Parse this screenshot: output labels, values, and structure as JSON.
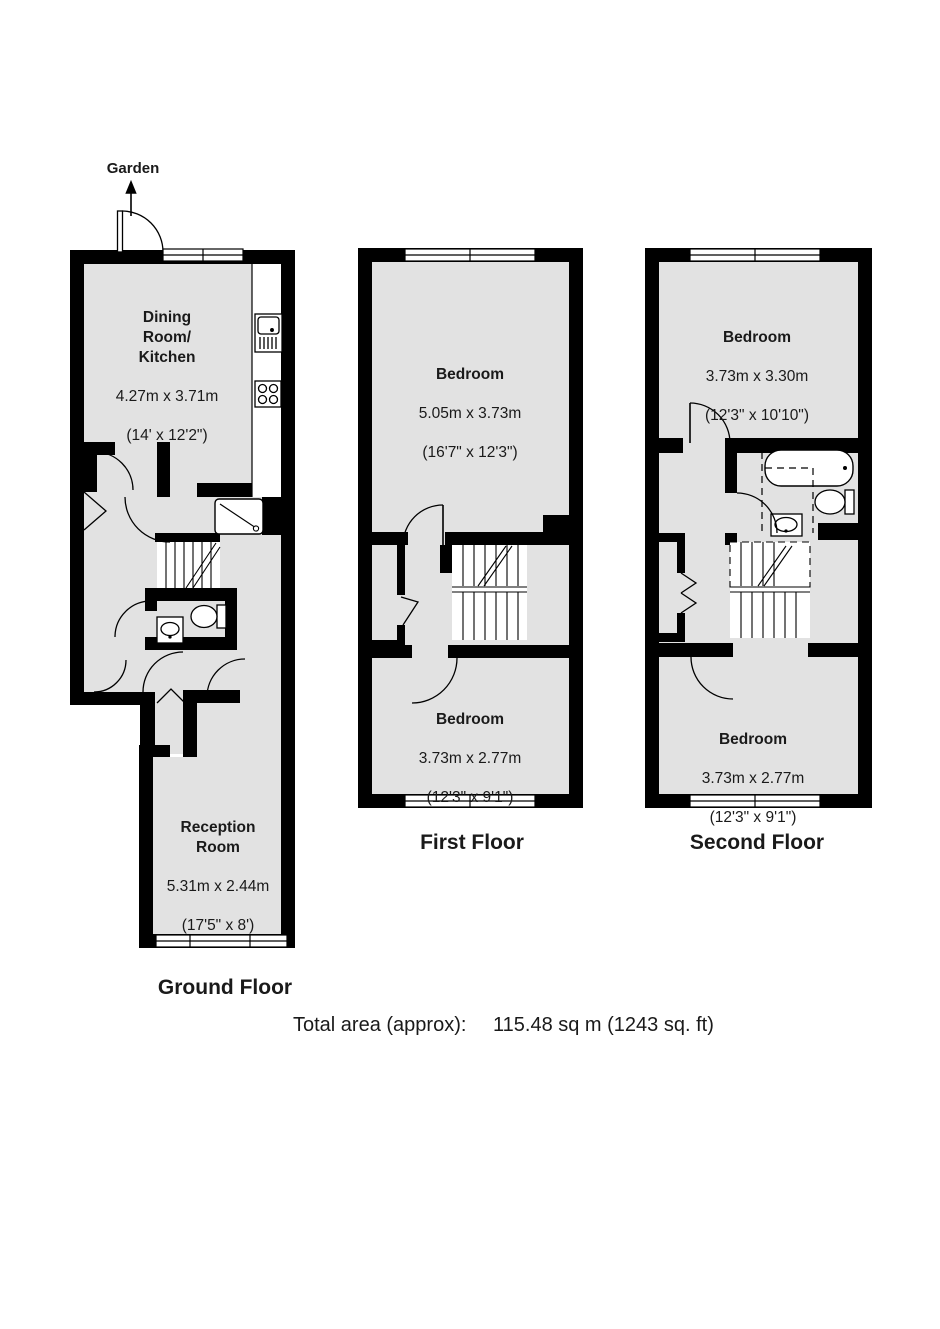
{
  "page": {
    "background": "#ffffff",
    "wall_color": "#000000",
    "room_fill": "#e2e2e2",
    "line_color": "#000000",
    "text_color": "#1a1a1a"
  },
  "garden": {
    "label": "Garden"
  },
  "floors": {
    "ground": {
      "caption": "Ground Floor",
      "rooms": {
        "dining_kitchen": {
          "name": "Dining\nRoom/\nKitchen",
          "dims_m": "4.27m x 3.71m",
          "dims_ft": "(14' x 12'2\")"
        },
        "reception": {
          "name": "Reception\nRoom",
          "dims_m": "5.31m x 2.44m",
          "dims_ft": "(17'5\" x 8')"
        }
      }
    },
    "first": {
      "caption": "First Floor",
      "rooms": {
        "bedroom1": {
          "name": "Bedroom",
          "dims_m": "5.05m x 3.73m",
          "dims_ft": "(16'7\" x 12'3\")"
        },
        "bedroom2": {
          "name": "Bedroom",
          "dims_m": "3.73m x 2.77m",
          "dims_ft": "(12'3\" x 9'1\")"
        }
      }
    },
    "second": {
      "caption": "Second Floor",
      "rooms": {
        "bedroom1": {
          "name": "Bedroom",
          "dims_m": "3.73m x 3.30m",
          "dims_ft": "(12'3\" x 10'10\")"
        },
        "bedroom2": {
          "name": "Bedroom",
          "dims_m": "3.73m x 2.77m",
          "dims_ft": "(12'3\" x 9'1\")"
        }
      }
    }
  },
  "summary": {
    "label": "Total area (approx):",
    "value": "115.48 sq m (1243 sq. ft)"
  }
}
